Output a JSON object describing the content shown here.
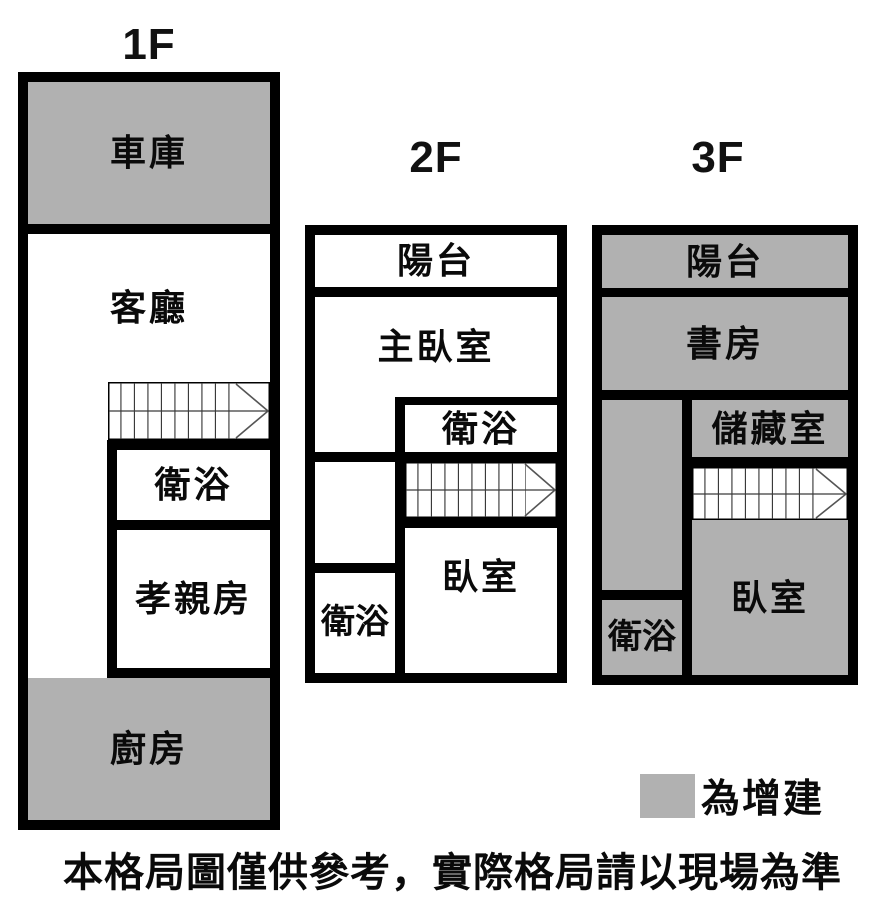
{
  "floors": [
    {
      "title": "1F",
      "rooms": {
        "garage": "車庫",
        "living": "客廳",
        "bath": "衛浴",
        "parents": "孝親房",
        "kitchen": "廚房"
      }
    },
    {
      "title": "2F",
      "rooms": {
        "balcony": "陽台",
        "master": "主臥室",
        "bath_upper": "衛浴",
        "bedroom": "臥室",
        "bath_lower": "衛浴"
      }
    },
    {
      "title": "3F",
      "rooms": {
        "balcony": "陽台",
        "study": "書房",
        "storage": "儲藏室",
        "bedroom": "臥室",
        "bath": "衛浴"
      }
    }
  ],
  "legend": {
    "swatch_meaning": "為增建"
  },
  "disclaimer": "本格局圖僅供參考，實際格局請以現場為準",
  "colors": {
    "addition_gray": "#b1b1b1",
    "wall_black": "#000000",
    "stair_line": "#3a3a3a"
  }
}
